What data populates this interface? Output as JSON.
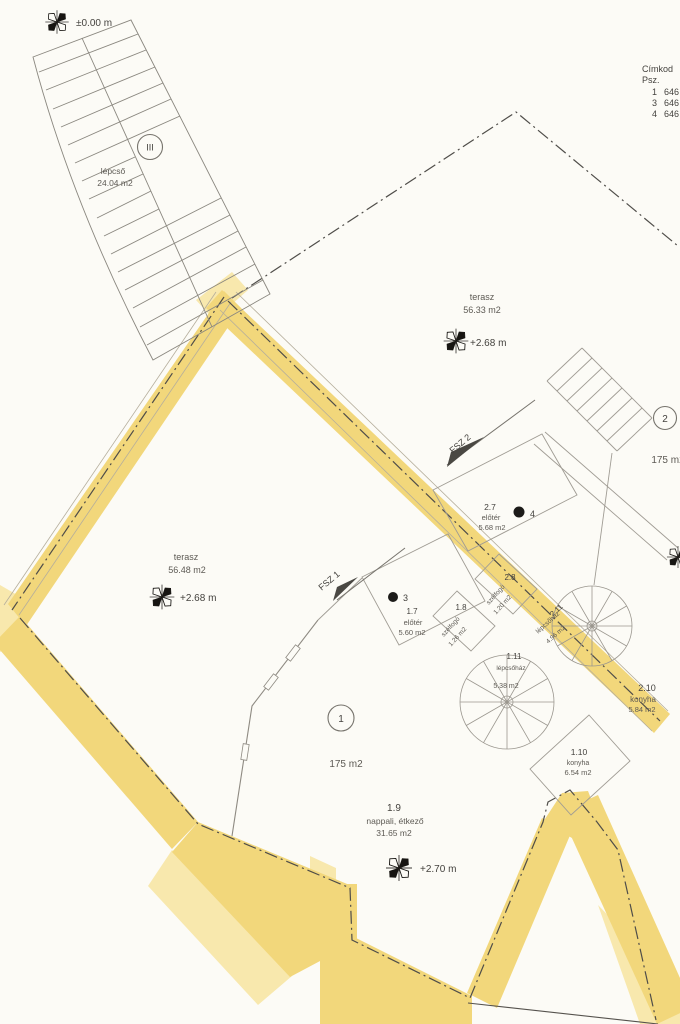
{
  "colors": {
    "highlight": "#f2d77b",
    "highlight_light": "#f8e8ad",
    "paper": "#fcfbf6"
  },
  "legend": {
    "title": "Címkod",
    "subtitle": "Psz.",
    "rows": [
      {
        "num": "1",
        "val": "646"
      },
      {
        "num": "3",
        "val": "646"
      },
      {
        "num": "4",
        "val": "646"
      }
    ]
  },
  "elevations": {
    "zero": "±0.00 m",
    "terrace_top": "+2.68 m",
    "terrace_left": "+2.68 m",
    "living": "+2.70 m"
  },
  "sections": {
    "fsz1": "FSZ 1",
    "fsz2": "FSZ 2"
  },
  "points": {
    "p3": "3",
    "p4": "4"
  },
  "badges": {
    "unit1": "1",
    "unit2": "2",
    "stair": "III"
  },
  "areas": {
    "unit1": "175 m2",
    "unit2": "175 m2"
  },
  "rooms": {
    "stairs": {
      "name": "lépcső",
      "area": "24.04 m2"
    },
    "terrace_top": {
      "name": "terasz",
      "area": "56.33 m2"
    },
    "terrace_left": {
      "name": "terasz",
      "area": "56.48 m2"
    },
    "r27": {
      "id": "2.7",
      "name": "előtér",
      "area": "5.68 m2"
    },
    "r17": {
      "id": "1.7",
      "name": "előtér",
      "area": "5.60 m2"
    },
    "r28": {
      "id": "2.8",
      "name": "szélfogó",
      "area": "1.20 m2"
    },
    "r18": {
      "id": "1.8",
      "name": "szélfogó",
      "area": "1.26 m2"
    },
    "r211": {
      "id": "2.11",
      "name": "lépcsőház",
      "area": "4.96 m2"
    },
    "r111": {
      "id": "1.11",
      "name": "lépcsőház",
      "area": "5.38 m2"
    },
    "r210": {
      "id": "2.10",
      "name": "konyha",
      "area": "5.84 m2"
    },
    "r110": {
      "id": "1.10",
      "name": "konyha",
      "area": "6.54 m2"
    },
    "r19": {
      "id": "1.9",
      "name": "nappali, étkező",
      "area": "31.65 m2"
    }
  }
}
